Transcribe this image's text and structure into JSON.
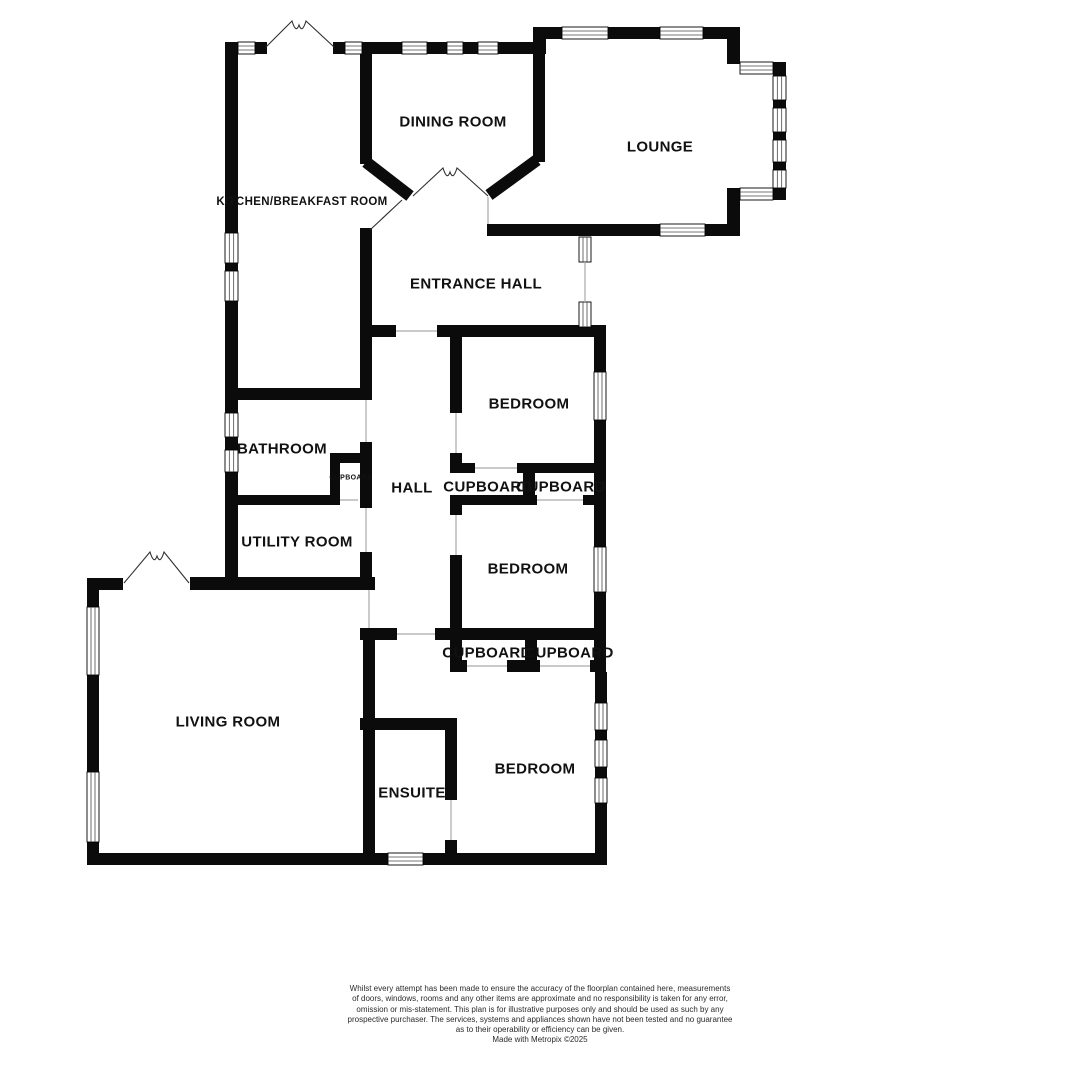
{
  "page": {
    "background": "#ffffff"
  },
  "plan": {
    "colors": {
      "wall": "#0b0b0b",
      "window_fill": "#ffffff",
      "window_frame": "#000000",
      "window_line": "#4a4a4a",
      "opening": "#aaaaaa",
      "door": "#2f2f2f",
      "label": "#111111"
    },
    "wall_thickness": 12,
    "walls": [
      [
        225,
        42,
        15,
        12
      ],
      [
        255,
        42,
        12,
        12
      ],
      [
        333,
        42,
        14,
        12
      ],
      [
        360,
        42,
        42,
        12
      ],
      [
        427,
        42,
        20,
        12
      ],
      [
        463,
        42,
        15,
        12
      ],
      [
        498,
        42,
        36,
        12
      ],
      [
        533,
        27,
        13,
        27
      ],
      [
        546,
        27,
        16,
        12
      ],
      [
        608,
        27,
        52,
        12
      ],
      [
        703,
        27,
        37,
        12
      ],
      [
        727,
        39,
        13,
        25
      ],
      [
        773,
        62,
        13,
        14
      ],
      [
        773,
        100,
        13,
        8
      ],
      [
        773,
        132,
        13,
        8
      ],
      [
        773,
        162,
        13,
        8
      ],
      [
        773,
        188,
        13,
        12
      ],
      [
        727,
        188,
        13,
        12
      ],
      [
        727,
        200,
        13,
        26
      ],
      [
        705,
        224,
        35,
        12
      ],
      [
        487,
        224,
        173,
        12
      ],
      [
        360,
        54,
        12,
        110
      ],
      [
        533,
        42,
        12,
        120
      ],
      [
        225,
        54,
        13,
        179
      ],
      [
        225,
        263,
        13,
        8
      ],
      [
        225,
        301,
        13,
        92
      ],
      [
        225,
        388,
        146,
        12
      ],
      [
        360,
        228,
        12,
        172
      ],
      [
        360,
        325,
        36,
        12
      ],
      [
        437,
        325,
        169,
        12
      ],
      [
        594,
        337,
        12,
        35
      ],
      [
        594,
        420,
        12,
        127
      ],
      [
        594,
        592,
        12,
        48
      ],
      [
        450,
        337,
        12,
        76
      ],
      [
        450,
        453,
        12,
        10
      ],
      [
        450,
        463,
        25,
        10
      ],
      [
        517,
        463,
        77,
        10
      ],
      [
        523,
        473,
        12,
        32
      ],
      [
        450,
        495,
        87,
        10
      ],
      [
        583,
        495,
        11,
        10
      ],
      [
        450,
        505,
        12,
        10
      ],
      [
        450,
        555,
        12,
        85
      ],
      [
        360,
        628,
        37,
        12
      ],
      [
        435,
        628,
        171,
        12
      ],
      [
        525,
        640,
        12,
        30
      ],
      [
        450,
        640,
        12,
        32
      ],
      [
        594,
        640,
        12,
        32
      ],
      [
        450,
        660,
        17,
        12
      ],
      [
        507,
        660,
        33,
        12
      ],
      [
        590,
        660,
        16,
        12
      ],
      [
        595,
        672,
        12,
        31
      ],
      [
        595,
        730,
        12,
        10
      ],
      [
        595,
        767,
        12,
        11
      ],
      [
        595,
        803,
        12,
        62
      ],
      [
        87,
        853,
        301,
        12
      ],
      [
        423,
        853,
        184,
        12
      ],
      [
        360,
        718,
        97,
        12
      ],
      [
        445,
        730,
        12,
        70
      ],
      [
        445,
        840,
        12,
        13
      ],
      [
        363,
        628,
        12,
        225
      ],
      [
        190,
        577,
        185,
        13
      ],
      [
        87,
        578,
        36,
        12
      ],
      [
        225,
        505,
        13,
        85
      ],
      [
        225,
        495,
        115,
        10
      ],
      [
        360,
        442,
        12,
        66
      ],
      [
        360,
        552,
        12,
        38
      ],
      [
        330,
        453,
        40,
        10
      ],
      [
        330,
        463,
        10,
        32
      ],
      [
        87,
        578,
        12,
        29
      ],
      [
        87,
        675,
        12,
        97
      ],
      [
        87,
        842,
        12,
        23
      ],
      [
        225,
        397,
        13,
        16
      ],
      [
        225,
        437,
        13,
        13
      ],
      [
        225,
        472,
        13,
        33
      ]
    ],
    "diagonal_walls": [
      [
        366,
        162,
        410,
        196
      ],
      [
        489,
        195,
        537,
        160
      ]
    ],
    "windows": [
      [
        238,
        42,
        17,
        12
      ],
      [
        345,
        42,
        17,
        12
      ],
      [
        402,
        42,
        25,
        12
      ],
      [
        447,
        42,
        16,
        12
      ],
      [
        478,
        42,
        20,
        12
      ],
      [
        562,
        27,
        46,
        12
      ],
      [
        660,
        27,
        43,
        12
      ],
      [
        740,
        62,
        33,
        12
      ],
      [
        773,
        76,
        13,
        24
      ],
      [
        773,
        108,
        13,
        24
      ],
      [
        773,
        140,
        13,
        22
      ],
      [
        773,
        170,
        13,
        18
      ],
      [
        740,
        188,
        33,
        12
      ],
      [
        660,
        224,
        45,
        12
      ],
      [
        225,
        233,
        13,
        30
      ],
      [
        225,
        271,
        13,
        30
      ],
      [
        579,
        237,
        12,
        25
      ],
      [
        579,
        302,
        12,
        25
      ],
      [
        594,
        372,
        12,
        48
      ],
      [
        594,
        547,
        12,
        45
      ],
      [
        225,
        413,
        13,
        24
      ],
      [
        225,
        450,
        13,
        22
      ],
      [
        595,
        703,
        12,
        27
      ],
      [
        595,
        740,
        12,
        27
      ],
      [
        595,
        778,
        12,
        25
      ],
      [
        388,
        853,
        35,
        12
      ],
      [
        87,
        607,
        12,
        68
      ],
      [
        87,
        772,
        12,
        70
      ]
    ],
    "openings": [
      [
        396,
        331,
        437,
        331
      ],
      [
        456,
        413,
        456,
        453
      ],
      [
        366,
        400,
        366,
        442
      ],
      [
        366,
        508,
        366,
        552
      ],
      [
        369,
        590,
        369,
        628
      ],
      [
        456,
        515,
        456,
        555
      ],
      [
        397,
        634,
        435,
        634
      ],
      [
        475,
        468,
        517,
        468
      ],
      [
        537,
        500,
        583,
        500
      ],
      [
        467,
        666,
        507,
        666
      ],
      [
        540,
        666,
        590,
        666
      ],
      [
        451,
        800,
        451,
        840
      ],
      [
        340,
        500,
        358,
        500
      ],
      [
        585,
        262,
        585,
        302
      ],
      [
        488,
        197,
        488,
        224
      ]
    ],
    "door_leaves": [
      [
        370,
        230,
        402,
        200
      ]
    ],
    "double_doors": [
      {
        "left": [
          266,
          47
        ],
        "apex": [
          299,
          21
        ],
        "right": [
          334,
          47
        ]
      },
      {
        "left": [
          413,
          196
        ],
        "apex": [
          450,
          168
        ],
        "right": [
          488,
          196
        ]
      },
      {
        "left": [
          124,
          583
        ],
        "apex": [
          157,
          552
        ],
        "right": [
          189,
          583
        ]
      }
    ],
    "rooms": [
      {
        "id": "dining-room",
        "label": "DINING ROOM",
        "x": 453,
        "y": 121,
        "font_size": 15
      },
      {
        "id": "lounge",
        "label": "LOUNGE",
        "x": 660,
        "y": 146,
        "font_size": 15
      },
      {
        "id": "kitchen-breakfast-room",
        "label": "KITCHEN/BREAKFAST ROOM",
        "x": 302,
        "y": 201,
        "font_size": 11.5
      },
      {
        "id": "entrance-hall",
        "label": "ENTRANCE HALL",
        "x": 476,
        "y": 283,
        "font_size": 15
      },
      {
        "id": "bedroom-1",
        "label": "BEDROOM",
        "x": 529,
        "y": 403,
        "font_size": 15
      },
      {
        "id": "bathroom",
        "label": "BATHROOM",
        "x": 282,
        "y": 448,
        "font_size": 15
      },
      {
        "id": "bathroom-cupboard",
        "label": "CUPBOARD",
        "x": 351,
        "y": 477,
        "font_size": 7
      },
      {
        "id": "hall",
        "label": "HALL",
        "x": 412,
        "y": 487,
        "font_size": 15
      },
      {
        "id": "cupboard-1",
        "label": "CUPBOARD",
        "x": 488,
        "y": 486,
        "font_size": 15
      },
      {
        "id": "cupboard-2",
        "label": "CUPBOARD",
        "x": 561,
        "y": 486,
        "font_size": 15
      },
      {
        "id": "utility-room",
        "label": "UTILITY ROOM",
        "x": 297,
        "y": 541,
        "font_size": 15
      },
      {
        "id": "bedroom-2",
        "label": "BEDROOM",
        "x": 528,
        "y": 568,
        "font_size": 15
      },
      {
        "id": "cupboard-3",
        "label": "CUPBOARD",
        "x": 487,
        "y": 652,
        "font_size": 15
      },
      {
        "id": "cupboard-4",
        "label": "CUPBOARD",
        "x": 569,
        "y": 652,
        "font_size": 15
      },
      {
        "id": "living-room",
        "label": "LIVING ROOM",
        "x": 228,
        "y": 721,
        "font_size": 15
      },
      {
        "id": "bedroom-3",
        "label": "BEDROOM",
        "x": 535,
        "y": 768,
        "font_size": 15
      },
      {
        "id": "ensuite",
        "label": "ENSUITE",
        "x": 412,
        "y": 792,
        "font_size": 15
      }
    ]
  },
  "disclaimer": {
    "lines": [
      "Whilst every attempt has been made to ensure the accuracy of the floorplan contained here, measurements",
      "of doors, windows, rooms and any other items are approximate and no responsibility is taken for any error,",
      "omission or mis-statement. This plan is for illustrative purposes only and should be used as such by any",
      "prospective purchaser. The services, systems and appliances shown have not been tested and no guarantee",
      "as to their operability or efficiency can be given."
    ],
    "credit": "Made with Metropix ©2025"
  }
}
